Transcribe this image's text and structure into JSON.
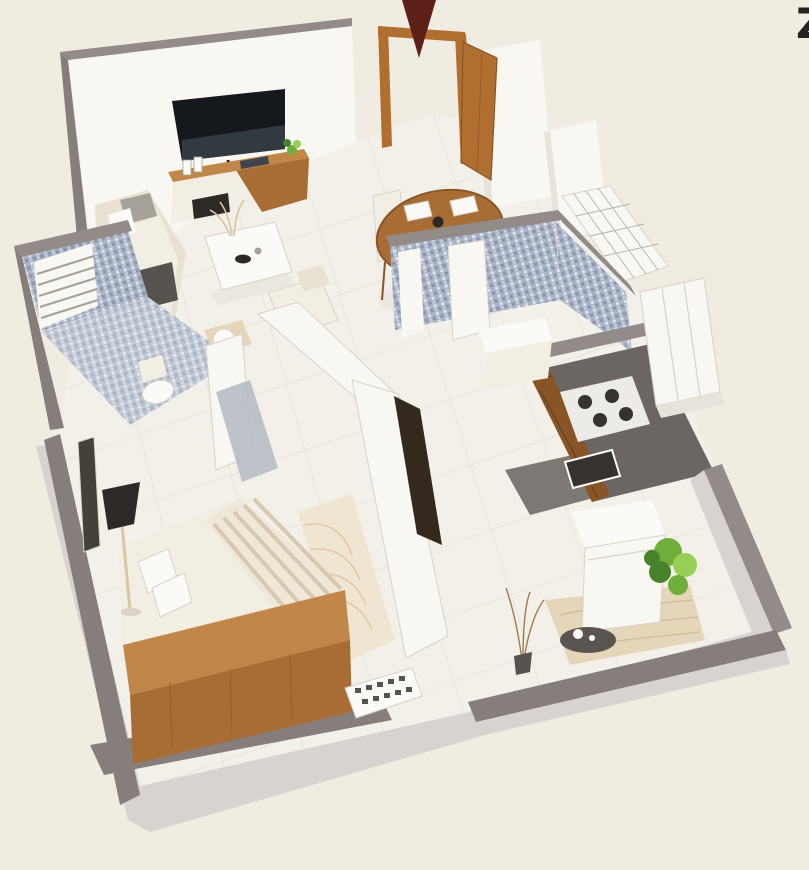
{
  "meta": {
    "kind": "3d-isometric-floor-plan-render",
    "subject": "1BHK apartment cutaway top view",
    "canvas": {
      "width": 809,
      "height": 870
    }
  },
  "annotations": {
    "partial_letter": "Z",
    "entry_marker": {
      "icon": "down-arrow-icon",
      "meaning": "main entrance direction",
      "color": "#5e2119"
    }
  },
  "palette": {
    "background": "#f1ece2",
    "slab": "#d8d3ce",
    "wall_gray": "#928b88",
    "wall_gray_dark": "#857e7b",
    "wall_white": "#f9f7f2",
    "wall_shade": "#e7e2da",
    "floor": "#f3f0e9",
    "grout": "#e3ddd3",
    "mosaic_base": "#aab4c6",
    "mosaic_dark": "#8d98b0",
    "mosaic_light": "#dde2ec",
    "mosaic_mid": "#c2cad9",
    "wood": "#a86c35",
    "wood_dark": "#8a5526",
    "wood_light": "#c08748",
    "door_wood": "#b06f30",
    "tv_screen": "#15181c",
    "tv_glare": "#3e444d",
    "counter": "#6b6662",
    "kitchen_floor": "#7e7874",
    "stove": "#edebe7",
    "burner": "#35322f",
    "fabric": "#e9e2d4",
    "fabric_light": "#f3eee3",
    "cushion_gray": "#a5a199",
    "cushion_dark": "#56524e",
    "stripe_a": "#d9c8af",
    "stripe_b": "#efe8d9",
    "rug": "#f0e5d0",
    "rug_line": "#d8c5a4",
    "plant": "#6fae3a",
    "plant_dark": "#47822a",
    "plant_light": "#96cf55",
    "lamp": "#2d2927",
    "arrow": "#5e2119",
    "glyph": "#272220",
    "white": "#fbfaf7",
    "outline": "#d8d2c8",
    "glass": "#b3bac2",
    "mat": "#e6d6b9",
    "mat_line": "#cdb894",
    "branch": "#9c7b4e",
    "steel": "#5a5551"
  }
}
